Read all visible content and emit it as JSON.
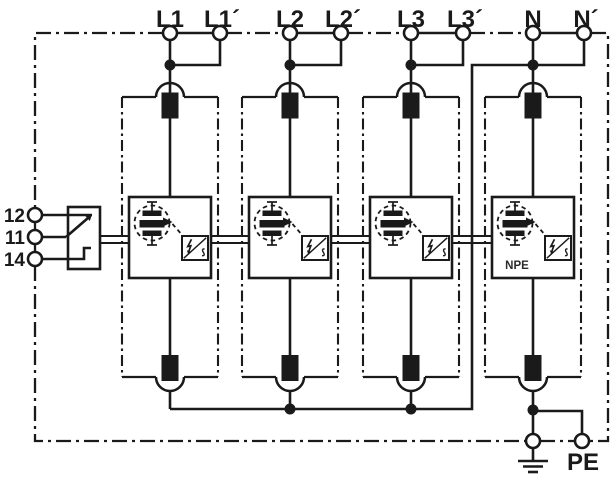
{
  "colors": {
    "ink": "#1a1a1a",
    "background": "#ffffff"
  },
  "terminals": {
    "top": [
      {
        "label": "L1"
      },
      {
        "label": "L1´"
      },
      {
        "label": "L2"
      },
      {
        "label": "L2´"
      },
      {
        "label": "L3"
      },
      {
        "label": "L3´"
      },
      {
        "label": "N"
      },
      {
        "label": "N´"
      }
    ],
    "signal": [
      {
        "label": "12"
      },
      {
        "label": "11"
      },
      {
        "label": "14"
      }
    ],
    "earth_label": "PE"
  },
  "modules": [
    {
      "name": "protection-module-l1",
      "badge": ""
    },
    {
      "name": "protection-module-l2",
      "badge": ""
    },
    {
      "name": "protection-module-l3",
      "badge": ""
    },
    {
      "name": "protection-module-n-pe",
      "badge": "NPE"
    }
  ],
  "icons": {
    "spark_gap_stack": "spark-gap-stack-icon",
    "trigger_circuit": "trigger-circuit-icon",
    "lightning": "lightning-icon",
    "plug_contact": "plug-contact-icon",
    "changeover_switch": "changeover-switch-icon",
    "earth_ground": "earth-ground-icon",
    "junction": "junction-dot",
    "terminal": "terminal-circle"
  }
}
